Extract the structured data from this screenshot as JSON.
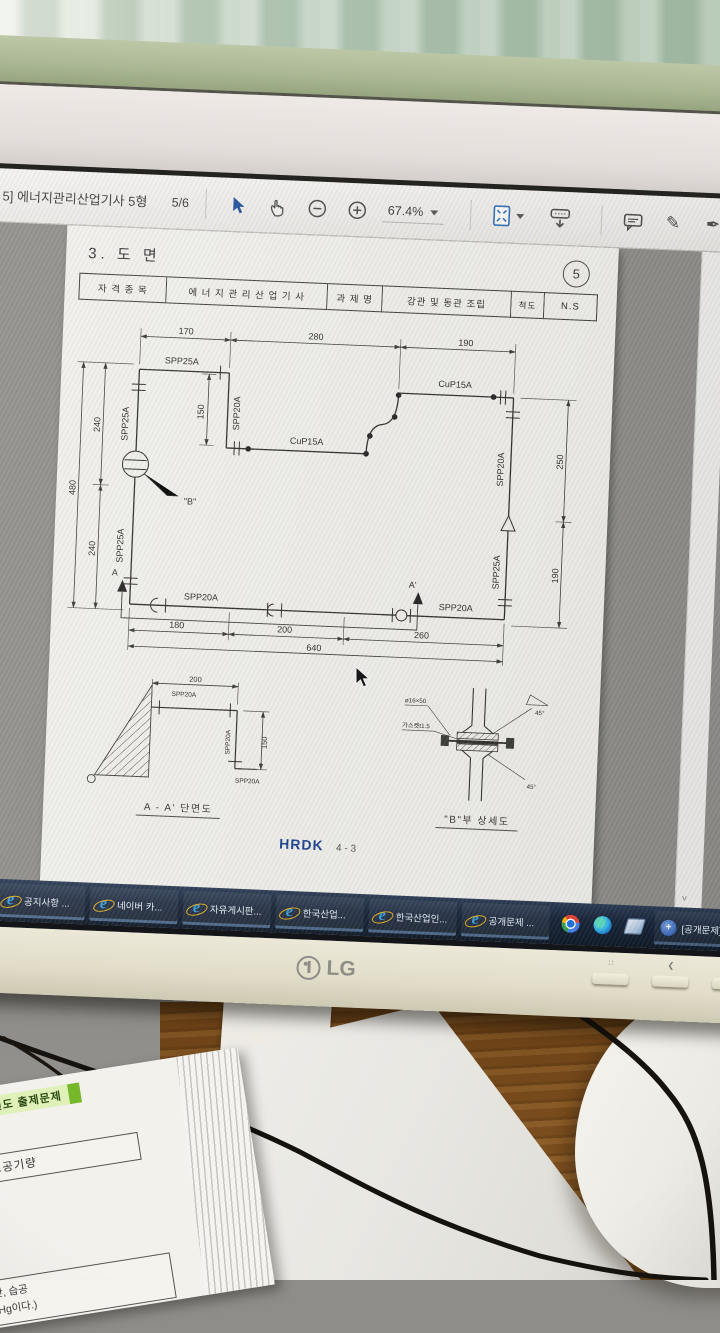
{
  "colors": {
    "accent_blue": "#1f4f9e",
    "taskbar_bg": "#0d1826",
    "ie_blue": "#35a3e8",
    "hrdk_navy": "#17418f",
    "wood": "#7b4e1e",
    "curtain_green": "#b7cab8",
    "bezel_cream": "#e2deca",
    "badge_green": "#76b82a",
    "pdf_gray": "#8f8e8a"
  },
  "toolbar": {
    "doc_title": "5] 에너지관리산업기사 5형",
    "page_indicator": "5/6",
    "zoom_level": "67.4%",
    "icons": [
      "select-tool",
      "hand-tool",
      "zoom-out",
      "zoom-in",
      "page-fit",
      "toolbar-download",
      "comment",
      "highlight",
      "sign",
      "fill-sign"
    ]
  },
  "document": {
    "section_title": "3. 도 면",
    "sheet_number": "5",
    "header": {
      "col1_label": "자 격 종 목",
      "col1_value": "에 너 지 관 리 산 업 기 사",
      "col2_label": "과 제 명",
      "col2_value": "강관 및 동관 조립",
      "col3_label": "척도",
      "col3_value": "N.S"
    },
    "footer": {
      "code": "HRDK",
      "page": "4 - 3"
    }
  },
  "diagram": {
    "dims": {
      "top": [
        "170",
        "280",
        "190"
      ],
      "left_outer": "480",
      "left_inner": [
        "240",
        "240"
      ],
      "notch": "150",
      "right": [
        "250",
        "190"
      ],
      "bottom": [
        "180",
        "200",
        "260"
      ],
      "bottom_total": "640"
    },
    "pipes": {
      "top_left": "SPP25A",
      "left_upper": "SPP25A",
      "left_lower": "SPP25A",
      "notch_vertical": "SPP20A",
      "notch_bottom": "CuP15A",
      "top_right": "CuP15A",
      "right_upper": "SPP20A",
      "right_lower": "SPP25A",
      "bottom_left": "SPP20A",
      "bottom_right": "SPP20A"
    },
    "markers": {
      "detail_b": "\"B\"",
      "section_a": "A",
      "section_a_prime": "A'"
    }
  },
  "detail_a": {
    "title": "A - A' 단면도",
    "dim_width": "200",
    "dim_height": "150",
    "pipe_top": "SPP20A",
    "pipe_vertical": "SPP20A",
    "pipe_bottom": "SPP20A"
  },
  "detail_b": {
    "title": "\"B\"부 상세도",
    "bolt": "ø16×50",
    "gasket": "가스켓t1.5",
    "angle_top": "45°",
    "angle_bottom": "45°"
  },
  "taskbar": {
    "items": [
      {
        "label": "공지사항 ..."
      },
      {
        "label": "네이버 카..."
      },
      {
        "label": "자유게시판..."
      },
      {
        "label": "한국산업..."
      },
      {
        "label": "한국산업인..."
      },
      {
        "label": "공개문제 ..."
      }
    ],
    "tray_item": "[공개문제]..."
  },
  "monitor": {
    "brand": "LG"
  },
  "desk_paper": {
    "badge": "과년도 출제문제",
    "box1": "필요한 소요공기량",
    "formula": "+2H₂O",
    "line1": "하시오.(단, 습공",
    "line2": "9.82mmHg이다.)"
  }
}
